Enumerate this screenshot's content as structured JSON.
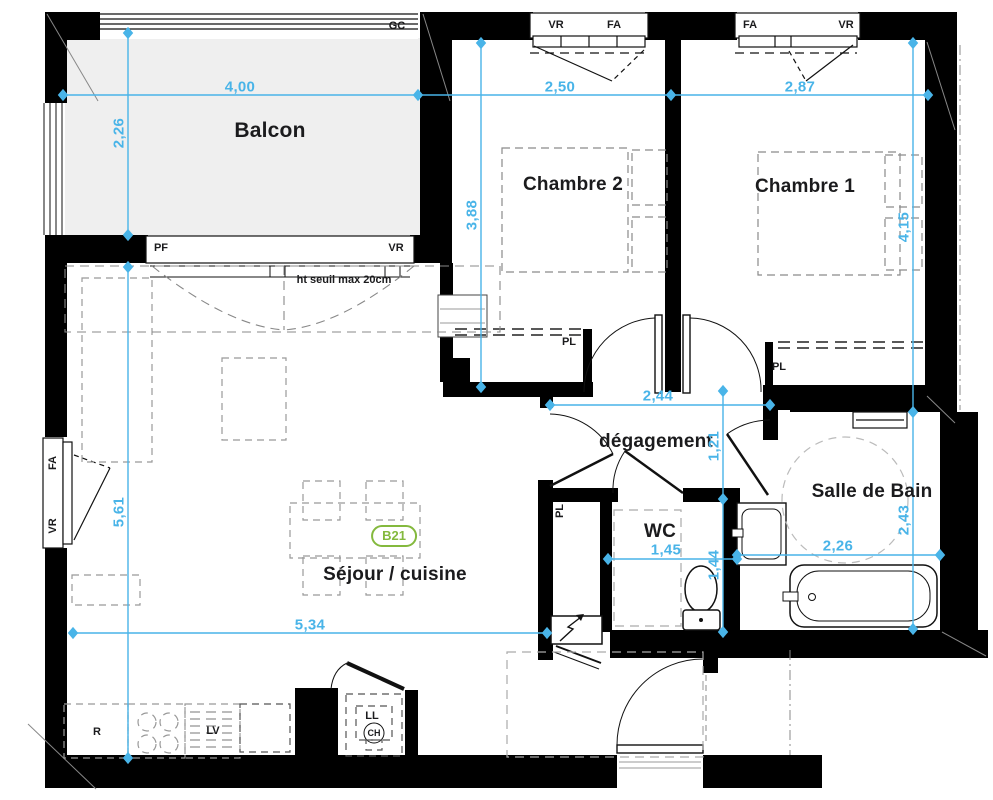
{
  "plan": {
    "unit_badge": "B21",
    "colors": {
      "dimension_blue": "#49b4e8",
      "wall_black": "#000000",
      "badge_green": "#84b93e",
      "balcony_fill": "#efefef"
    },
    "rooms": {
      "balcon": "Balcon",
      "chambre2": "Chambre 2",
      "chambre1": "Chambre 1",
      "degagement": "dégagement",
      "wc": "WC",
      "salle_de_bain": "Salle de Bain",
      "sejour_cuisine": "Séjour / cuisine"
    },
    "dimensions": {
      "balcon_width": "4,00",
      "chambre2_width": "2,50",
      "chambre1_width": "2,87",
      "balcon_depth": "2,26",
      "chambre2_depth": "3,88",
      "chambre1_depth": "4,15",
      "degagement_width": "2,44",
      "degagement_depth": "1,21",
      "sejour_depth": "5,61",
      "sejour_width": "5,34",
      "wc_width": "1,45",
      "wc_depth": "1,44",
      "sdb_width": "2,26",
      "sdb_depth": "2,43"
    },
    "annotations": {
      "gc": "GC",
      "vr": "VR",
      "fa": "FA",
      "pf": "PF",
      "pl": "PL",
      "seuil_note": "ht seuil max 20cm",
      "fridge": "R",
      "dishwasher": "LV",
      "washer": "LL",
      "water_heater": "CH"
    }
  }
}
